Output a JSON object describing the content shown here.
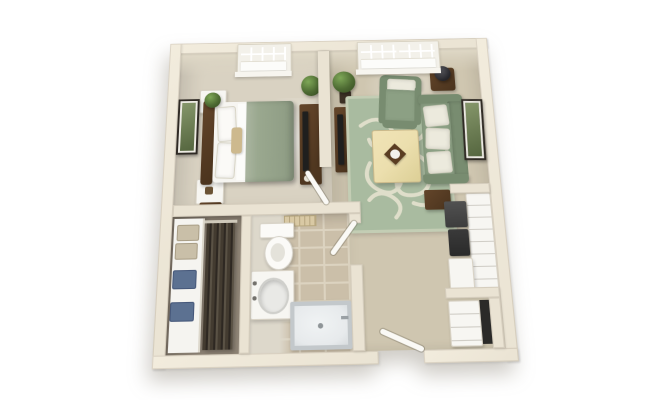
{
  "page": {
    "background": "#ffffff"
  },
  "palette": {
    "page_bg": "#ffffff",
    "wall": "#eae3d3",
    "wall_bright": "#f2ecdd",
    "wall_face": "#e2dbc9",
    "bed_floor": "#d9d2c2",
    "liv_floor": "#cfc6b0",
    "closet_floor": "#968b7c",
    "tile": "#cbbfa9",
    "grout": "#dcd3c0",
    "bath_light": "#ddd8cb",
    "rug": "#a9bba0",
    "rug_accent": "#e9e5d2",
    "sage": "#8ca084",
    "sage_dark": "#788c70",
    "wood": "#63452a",
    "wood_dark": "#4a331d",
    "furn_white": "#f7f6f2",
    "tv": "#1f1f1e",
    "pillow": "#eceadd",
    "plant": "#4e6b33",
    "plant_dark": "#33491f",
    "shower": "#e7eaec",
    "shower_rim": "#c3c8cb",
    "frame": "#2f2a24",
    "art_green": "#55663f",
    "box_blue": "#5c7191",
    "box_tan": "#c9bfa8",
    "table_cream": "#ecdfae",
    "duvet": "#9aa88f"
  },
  "floorplan": {
    "style": "3d-rendered-top-down",
    "rooms": [
      {
        "name": "bedroom",
        "furniture": [
          "double-bed",
          "headboard",
          "cube-nightstand-top",
          "cube-nightstand-bottom",
          "tv-console",
          "wall-art",
          "window",
          "corner-plant",
          "door"
        ]
      },
      {
        "name": "living-room",
        "furniture": [
          "sofa",
          "armchair",
          "coffee-table",
          "area-rug",
          "tv-console",
          "side-table-with-lamp",
          "wall-art",
          "double-window",
          "plant"
        ]
      },
      {
        "name": "bathroom",
        "furniture": [
          "toilet",
          "vanity-sink",
          "shower",
          "tile-floor",
          "wall-vent",
          "door"
        ]
      },
      {
        "name": "closet",
        "furniture": [
          "shelving-unit",
          "storage-bins",
          "hanging-clothes"
        ]
      },
      {
        "name": "kitchenette",
        "furniture": [
          "counter-run",
          "microwave",
          "oven",
          "base-cabinet",
          "storage-dresser",
          "appliance-slot",
          "entry-door"
        ]
      }
    ]
  }
}
